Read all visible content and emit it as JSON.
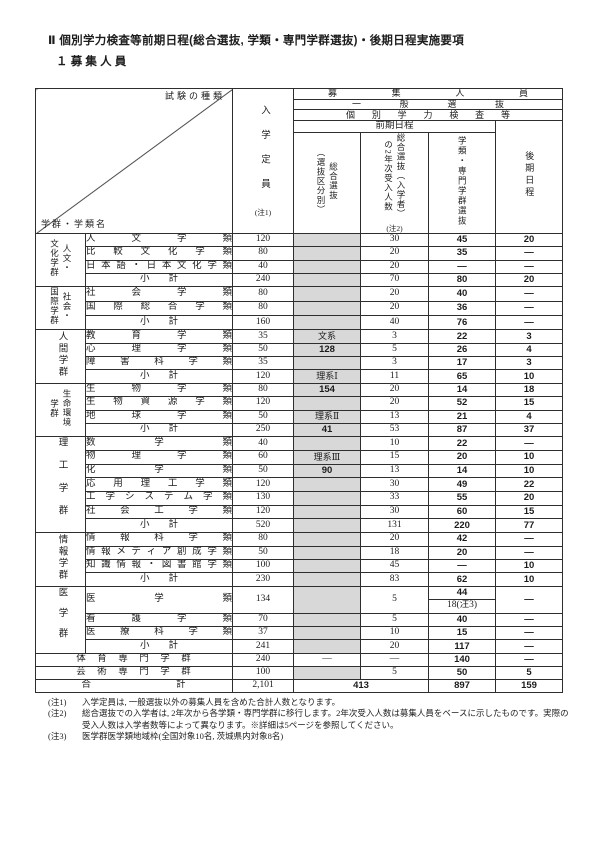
{
  "page": {
    "title": "Ⅱ 個別学力検査等前期日程(総合選抜, 学類・専門学群選抜)・後期日程実施要項",
    "subtitle": "１ 募 集 人 員"
  },
  "table": {
    "corner": {
      "exam_type": "試験の種類",
      "group_name": "学群・学類名"
    },
    "header": {
      "boshu": "募 集 人 員",
      "ippan": "一 般 選 抜",
      "kobetsu": "個 別 学 力 検 査 等",
      "zenki": "前期日程",
      "col_teiin": "入学定員",
      "col_teiin_note": "(注1)",
      "col_sogo": "総合選抜\n（選抜区分別）",
      "col_nenji": "総合選抜（入学者）\nの2年次受入人数",
      "col_nenji_note": "(注2)",
      "col_gakurui": "学類・専門学群選抜",
      "col_kouki": "後期日程"
    },
    "groups": [
      {
        "label": "人文・\n文化学群",
        "rows": [
          {
            "name": "人文学類",
            "teiin": "120",
            "sogo": "",
            "nenji": "30",
            "gakurui": "45",
            "kouki": "20"
          },
          {
            "name": "比較文化学類",
            "teiin": "80",
            "sogo": "",
            "nenji": "20",
            "gakurui": "35",
            "kouki": "—"
          },
          {
            "name": "日本語・日本文化学類",
            "teiin": "40",
            "sogo": "",
            "nenji": "20",
            "gakurui": "—",
            "kouki": "—"
          },
          {
            "name": "小　　計",
            "type": "subtotal",
            "teiin": "240",
            "sogo": "",
            "nenji": "70",
            "gakurui": "80",
            "kouki": "20"
          }
        ]
      },
      {
        "label": "社会・\n国際学群",
        "rows": [
          {
            "name": "社会学類",
            "teiin": "80",
            "sogo": "",
            "nenji": "20",
            "gakurui": "40",
            "kouki": "—"
          },
          {
            "name": "国際総合学類",
            "teiin": "80",
            "sogo": "",
            "nenji": "20",
            "gakurui": "36",
            "kouki": "—"
          },
          {
            "name": "小　　計",
            "type": "subtotal",
            "teiin": "160",
            "sogo": "",
            "nenji": "40",
            "gakurui": "76",
            "kouki": "—"
          }
        ]
      },
      {
        "label": "人間学群",
        "rows": [
          {
            "name": "教育学類",
            "teiin": "35",
            "sogo": "文系",
            "nenji": "3",
            "gakurui": "22",
            "kouki": "3"
          },
          {
            "name": "心理学類",
            "teiin": "50",
            "sogo": "128",
            "nenji": "5",
            "gakurui": "26",
            "kouki": "4"
          },
          {
            "name": "障害科学類",
            "teiin": "35",
            "sogo": "",
            "nenji": "3",
            "gakurui": "17",
            "kouki": "3"
          },
          {
            "name": "小　　計",
            "type": "subtotal",
            "teiin": "120",
            "sogo": "理系Ⅰ",
            "nenji": "11",
            "gakurui": "65",
            "kouki": "10"
          }
        ]
      },
      {
        "label": "生命環境\n学群",
        "rows": [
          {
            "name": "生物学類",
            "teiin": "80",
            "sogo": "154",
            "nenji": "20",
            "gakurui": "14",
            "kouki": "18"
          },
          {
            "name": "生物資源学類",
            "teiin": "120",
            "sogo": "",
            "nenji": "20",
            "gakurui": "52",
            "kouki": "15"
          },
          {
            "name": "地球学類",
            "teiin": "50",
            "sogo": "理系Ⅱ",
            "nenji": "13",
            "gakurui": "21",
            "kouki": "4"
          },
          {
            "name": "小　　計",
            "type": "subtotal",
            "teiin": "250",
            "sogo": "41",
            "nenji": "53",
            "gakurui": "87",
            "kouki": "37"
          }
        ]
      },
      {
        "label": "理工学群",
        "rows": [
          {
            "name": "数学類",
            "teiin": "40",
            "sogo": "",
            "nenji": "10",
            "gakurui": "22",
            "kouki": "—"
          },
          {
            "name": "物理学類",
            "teiin": "60",
            "sogo": "理系Ⅲ",
            "nenji": "15",
            "gakurui": "20",
            "kouki": "10"
          },
          {
            "name": "化学類",
            "teiin": "50",
            "sogo": "90",
            "nenji": "13",
            "gakurui": "14",
            "kouki": "10"
          },
          {
            "name": "応用理工学類",
            "teiin": "120",
            "sogo": "",
            "nenji": "30",
            "gakurui": "49",
            "kouki": "22"
          },
          {
            "name": "工学システム学類",
            "teiin": "130",
            "sogo": "",
            "nenji": "33",
            "gakurui": "55",
            "kouki": "20"
          },
          {
            "name": "社会工学類",
            "teiin": "120",
            "sogo": "",
            "nenji": "30",
            "gakurui": "60",
            "kouki": "15"
          },
          {
            "name": "小　　計",
            "type": "subtotal",
            "teiin": "520",
            "sogo": "",
            "nenji": "131",
            "gakurui": "220",
            "kouki": "77"
          }
        ]
      },
      {
        "label": "情報学群",
        "rows": [
          {
            "name": "情報科学類",
            "teiin": "80",
            "sogo": "",
            "nenji": "20",
            "gakurui": "42",
            "kouki": "—"
          },
          {
            "name": "情報メディア創成学類",
            "teiin": "50",
            "sogo": "",
            "nenji": "18",
            "gakurui": "20",
            "kouki": "—"
          },
          {
            "name": "知識情報・図書館学類",
            "teiin": "100",
            "sogo": "",
            "nenji": "45",
            "gakurui": "—",
            "kouki": "10"
          },
          {
            "name": "小　　計",
            "type": "subtotal",
            "teiin": "230",
            "sogo": "",
            "nenji": "83",
            "gakurui": "62",
            "kouki": "10"
          }
        ]
      },
      {
        "label": "医学群",
        "rows": [
          {
            "name": "医学類",
            "teiin": "134",
            "sogo": "",
            "nenji": "5",
            "gakurui_split": [
              "44",
              "18(注3)"
            ],
            "kouki": "—"
          },
          {
            "name": "看護学類",
            "teiin": "70",
            "sogo": "",
            "nenji": "5",
            "gakurui": "40",
            "kouki": "—"
          },
          {
            "name": "医療科学類",
            "teiin": "37",
            "sogo": "",
            "nenji": "10",
            "gakurui": "15",
            "kouki": "—"
          },
          {
            "name": "小　　計",
            "type": "subtotal",
            "teiin": "241",
            "sogo": "",
            "nenji": "20",
            "gakurui": "117",
            "kouki": "—"
          }
        ]
      }
    ],
    "sports_row": {
      "name": "体　育　専　門　学　群",
      "teiin": "240",
      "sogo": "—",
      "nenji": "—",
      "gakurui": "140",
      "kouki": "—"
    },
    "arts_row": {
      "name": "芸　術　専　門　学　群",
      "teiin": "100",
      "sogo": "",
      "nenji": "5",
      "gakurui": "50",
      "kouki": "5"
    },
    "total_row": {
      "name": "合　　　　　　　　計",
      "teiin": "2,101",
      "zenki_combined": "413",
      "gakurui": "897",
      "kouki": "159"
    }
  },
  "notes": [
    {
      "label": "(注1)",
      "text": "入学定員は, 一般選抜以外の募集人員を含めた合計人数となります。"
    },
    {
      "label": "(注2)",
      "text": "総合選抜での入学者は, 2年次から各学類・専門学群に移行します。2年次受入人数は募集人員をベースに示したものです。実際の受入人数は入学者数等によって異なります。※詳細は5ページを参照してください。"
    },
    {
      "label": "(注3)",
      "text": "医学群医学類地域枠(全国対象10名, 茨城県内対象8名)"
    }
  ]
}
